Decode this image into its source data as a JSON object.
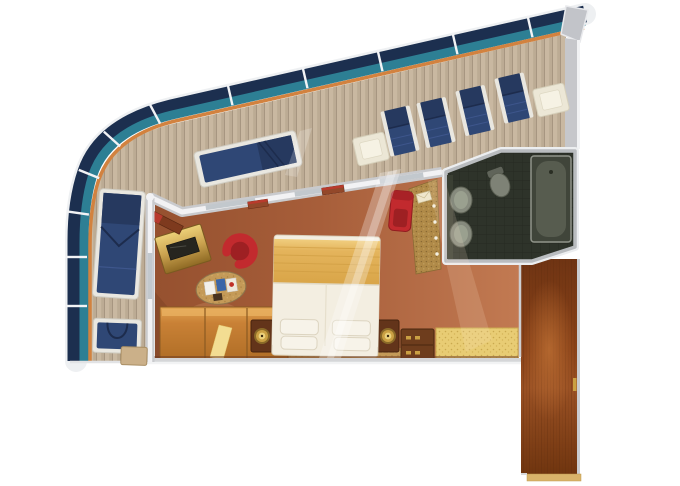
{
  "floorplan": {
    "kind": "cruise-ship-suite-deck-plan",
    "areas": [
      "balcony-deck",
      "stateroom",
      "bathroom",
      "entry-corridor"
    ],
    "legend": {
      "balcony_furniture": [
        "double-sun-lounger",
        "sun-lounger",
        "deck-chair",
        "deck-chair",
        "deck-chair",
        "deck-chair",
        "side-table",
        "side-table",
        "balcony-chair",
        "balcony-side-table"
      ],
      "stateroom_furniture": [
        "king-bed",
        "nightstand",
        "nightstand",
        "table-lamp",
        "table-lamp",
        "desk",
        "tv",
        "tub-chair",
        "magazine-table",
        "wardrobe",
        "drawer-chest",
        "bench-seat",
        "vanity-counter",
        "vanity-chair",
        "wall-shelf"
      ],
      "bathroom_fixtures": [
        "bathtub",
        "sink",
        "sink",
        "toilet"
      ],
      "corridor_features": [
        "entry-door-threshold",
        "door-handle"
      ]
    },
    "counts": {
      "deck_chairs": 4,
      "loungers": 2,
      "balcony_tables": 3,
      "pillows": 4,
      "sinks": 2
    },
    "colors": {
      "background": "#ffffff",
      "railing_rim": "#eef0f2",
      "railing_navy": "#1c2f4f",
      "railing_teal": "#2d7f94",
      "railing_cap_orange": "#d2823f",
      "deck_wood": "#c9b8a1",
      "deck_plank_line": "#a79681",
      "wall_gray": "#c9cacd",
      "wall_white": "#f2f2f4",
      "glass_gray": "#c2c8cd",
      "carpet_dark": "#96512f",
      "carpet_mid": "#a75e3a",
      "carpet_light": "#c27a52",
      "bed_linen": "#f3eee1",
      "bed_gold": "#e4b45c",
      "pillow_white": "#f7f3e9",
      "runner_tan": "#c49a58",
      "lounger_navy": "#2f4775",
      "lounger_navy_dark": "#26395f",
      "frame_white": "#e9e7e0",
      "table_cream": "#ece7d6",
      "wardrobe_oak": "#c98136",
      "desk_brass": "#caa24f",
      "tv_black": "#26251f",
      "chair_red": "#c22a2e",
      "chair_red_dark": "#9e2023",
      "bathroom_tile": "#2e332a",
      "fixture_gray": "#868a7d",
      "tub_inner": "#575c4f",
      "corridor_wood": "#8a4218",
      "bench_gold": "#e8cc74",
      "vanity_gold": "#b08a48",
      "nightstand_wood": "#63341a",
      "lamp_gold": "#caa043",
      "threshold_tan": "#d9b36a"
    }
  }
}
